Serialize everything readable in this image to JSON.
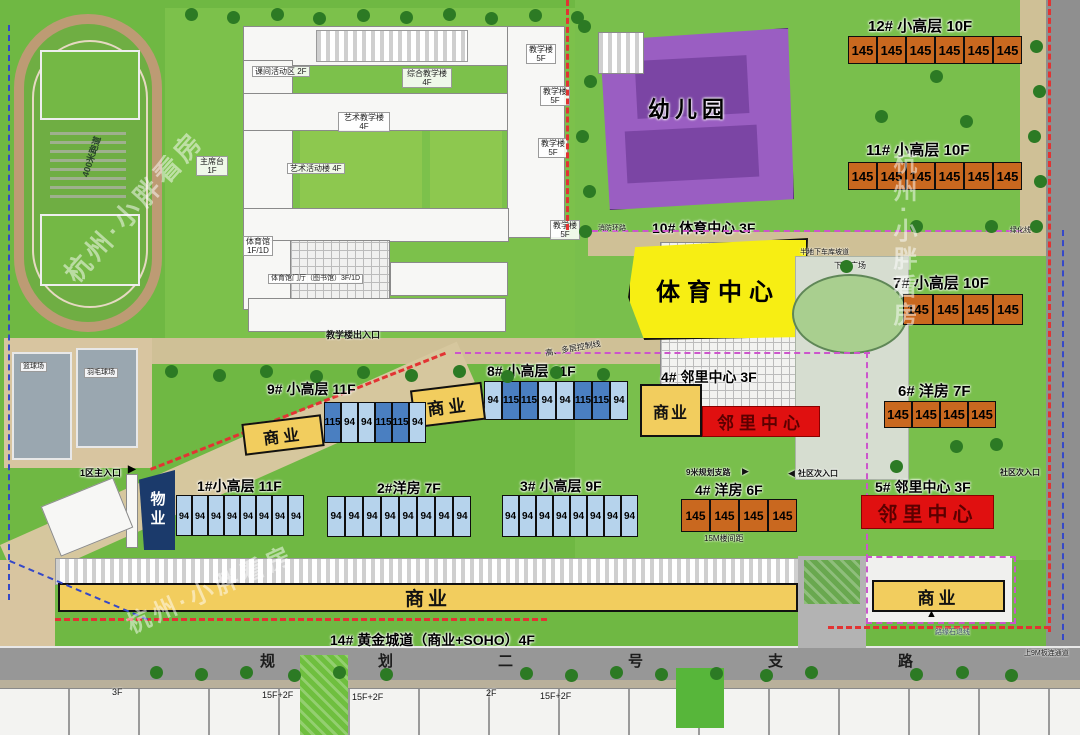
{
  "watermark": {
    "text": "杭州·小胖看房"
  },
  "school": {
    "labels": {
      "activity": "课间活动区 2F",
      "complex": "综合教学楼 4F",
      "art_teach": "艺术教学楼",
      "art_act": "艺术活动楼 4F",
      "teach": "教学楼",
      "teach_floor": "5F",
      "floor4": "4F",
      "gym": "体育馆",
      "gym_floor": "1F/1D",
      "gym_hall": "体育馆门厅（图书馆）3F/1D",
      "exit": "教学楼出入口",
      "stage": "主席台 1F",
      "track": "400米跑道",
      "basketball": "篮球场",
      "badminton": "羽毛球场"
    }
  },
  "kindergarten": {
    "name": "幼儿园"
  },
  "sports_center": {
    "label": "10#  体育中心  3F",
    "name": "体育中心"
  },
  "buildings": {
    "b12": {
      "label": "12#  小高层  10F",
      "units": [
        "145",
        "145",
        "145",
        "145",
        "145",
        "145"
      ]
    },
    "b11": {
      "label": "11#  小高层  10F",
      "units": [
        "145",
        "145",
        "145",
        "145",
        "145",
        "145"
      ]
    },
    "b7": {
      "label": "7#  小高层  10F",
      "units": [
        "145",
        "145",
        "145",
        "145"
      ]
    },
    "b6": {
      "label": "6#  洋房  7F",
      "units": [
        "145",
        "145",
        "145",
        "145"
      ]
    },
    "b8": {
      "label": "8#  小高层  11F",
      "units": [
        "94",
        "115",
        "115",
        "94",
        "94",
        "115",
        "115",
        "94"
      ]
    },
    "b9": {
      "label": "9#  小高层  11F",
      "units": [
        "115",
        "94",
        "94",
        "115",
        "115",
        "94"
      ]
    },
    "b1": {
      "label": "1#小高层  11F",
      "units": [
        "94",
        "94",
        "94",
        "94",
        "94",
        "94",
        "94",
        "94"
      ]
    },
    "b2": {
      "label": "2#洋房  7F",
      "units": [
        "94",
        "94",
        "94",
        "94",
        "94",
        "94",
        "94",
        "94"
      ]
    },
    "b3": {
      "label": "3#  小高层  9F",
      "units": [
        "94",
        "94",
        "94",
        "94",
        "94",
        "94",
        "94",
        "94"
      ]
    },
    "b4": {
      "label": "4#  洋房  6F",
      "units": [
        "145",
        "145",
        "145",
        "145"
      ]
    }
  },
  "neighborhood": {
    "c4": {
      "label": "4#  邻里中心  3F",
      "commercial": "商业",
      "name": "邻里中心"
    },
    "c5": {
      "label": "5#  邻里中心  3F",
      "name": "邻里中心"
    }
  },
  "commercial": {
    "label": "商业",
    "strip14": "14#  黄金城道（商业+SOHO）4F"
  },
  "property": {
    "name": "物业"
  },
  "road": {
    "chars": [
      "规",
      "划",
      "二",
      "号",
      "支",
      "路"
    ]
  },
  "annotations": {
    "main_entrance": "1区主入口",
    "fire_lane": "消防环路",
    "garage_ramp": "半地下车库坡道",
    "sunken_plaza": "下沉广场",
    "green_line": "绿化线",
    "side_entrance": "社区次入口",
    "side_road9m": "9米规划支路",
    "spacing15m": "15M楼间距",
    "control_line": "高、多层控制线",
    "board9m": "上9M板连通道",
    "curb_line": "路缘石退线",
    "arrow_right": "▶",
    "arrow_left": "◀",
    "arrow_up": "▲"
  },
  "south_buildings": {
    "f3": "3F",
    "f15a": "15F+2F",
    "f15b": "15F+2F",
    "f2": "2F",
    "f15c": "15F+2F"
  }
}
